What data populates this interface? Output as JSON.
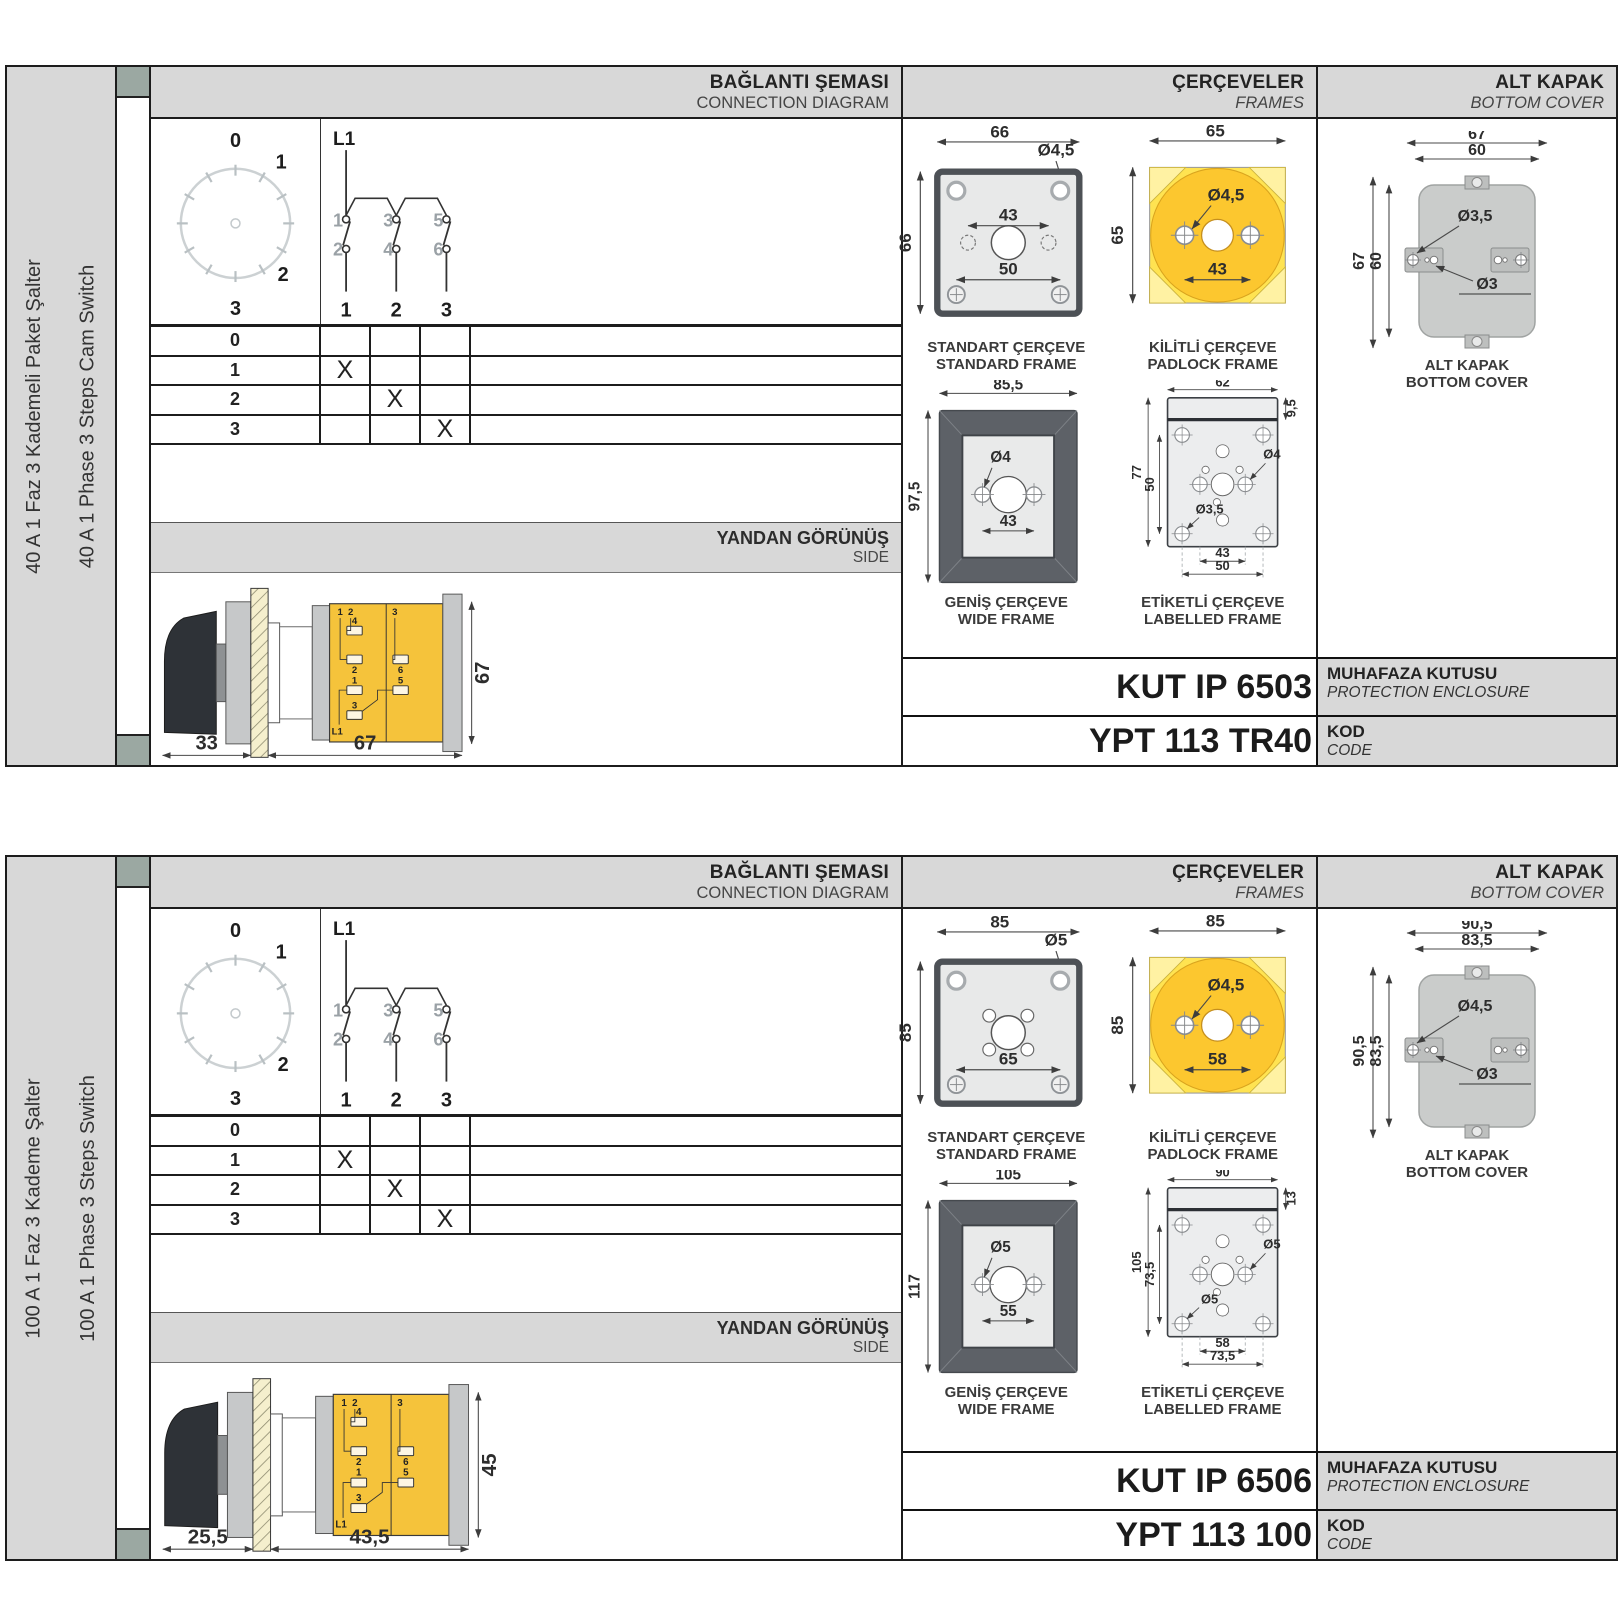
{
  "sections": [
    {
      "side_label_tr": "40 A 1 Faz 3 Kademeli Paket Şalter",
      "side_label_en": "40 A 1 Phase 3 Steps Cam Switch",
      "headers": {
        "connection_tr": "BAĞLANTI ŞEMASI",
        "connection_en": "CONNECTION DIAGRAM",
        "frames_tr": "ÇERÇEVELER",
        "frames_en": "FRAMES",
        "cover_tr": "ALT KAPAK",
        "cover_en": "BOTTOM COVER",
        "side_tr": "YANDAN GÖRÜNÜŞ",
        "side_en": "SIDE"
      },
      "dial": {
        "p0": "0",
        "p1": "1",
        "p2": "2",
        "p3": "3"
      },
      "circuit": {
        "phase": "L1",
        "c1": "1",
        "c2": "2",
        "c3": "3",
        "c4": "4",
        "c5": "5",
        "c6": "6",
        "o1": "1",
        "o2": "2",
        "o3": "3"
      },
      "table": {
        "rows": [
          {
            "label": "0",
            "c1": "",
            "c2": "",
            "c3": ""
          },
          {
            "label": "1",
            "c1": "X",
            "c2": "",
            "c3": ""
          },
          {
            "label": "2",
            "c1": "",
            "c2": "X",
            "c3": ""
          },
          {
            "label": "3",
            "c1": "",
            "c2": "",
            "c3": "X"
          }
        ]
      },
      "side_view": {
        "dim_handle": "33",
        "dim_body": "67",
        "dim_height": "67",
        "k1": "1",
        "k2": "2",
        "k3": "3",
        "t4": "4",
        "t2": "2",
        "t1": "1",
        "t3": "3",
        "t6": "6",
        "t5": "5",
        "l1": "L1"
      },
      "frames": {
        "standard": {
          "cap_tr": "STANDART ÇERÇEVE",
          "cap_en": "STANDARD FRAME",
          "dim_w": "66",
          "dim_h": "66",
          "hole": "Ø4,5",
          "dim_mid": "43",
          "dim_bot": "50"
        },
        "padlock": {
          "cap_tr": "KİLİTLİ ÇERÇEVE",
          "cap_en": "PADLOCK FRAME",
          "dim_w": "65",
          "dim_h": "65",
          "hole": "Ø4,5",
          "dim_mid": "43"
        },
        "wide": {
          "cap_tr": "GENİŞ ÇERÇEVE",
          "cap_en": "WIDE FRAME",
          "dim_w": "85,5",
          "dim_h": "97,5",
          "hole": "Ø4",
          "dim_mid": "43"
        },
        "labelled": {
          "cap_tr": "ETİKETLİ ÇERÇEVE",
          "cap_en": "LABELLED FRAME",
          "dim_w": "62",
          "dim_strip": "9,5",
          "dim_h": "77",
          "dim_inner": "50",
          "hole_big": "Ø4",
          "hole_small": "Ø3,5",
          "dim_b1": "43",
          "dim_b2": "50"
        }
      },
      "cover": {
        "cap_tr": "ALT KAPAK",
        "cap_en": "BOTTOM COVER",
        "dim_w1": "67",
        "dim_w2": "60",
        "dim_h1": "67",
        "dim_h2": "60",
        "hole1": "Ø3,5",
        "hole2": "Ø3"
      },
      "enclosure": {
        "value": "KUT IP 6503",
        "label_tr": "MUHAFAZA KUTUSU",
        "label_en": "PROTECTION ENCLOSURE"
      },
      "code": {
        "value": "YPT 113 TR40",
        "label_tr": "KOD",
        "label_en": "CODE"
      }
    },
    {
      "side_label_tr": "100 A 1 Faz 3 Kademe Şalter",
      "side_label_en": "100 A 1 Phase 3 Steps Switch",
      "headers": {
        "connection_tr": "BAĞLANTI ŞEMASI",
        "connection_en": "CONNECTION DIAGRAM",
        "frames_tr": "ÇERÇEVELER",
        "frames_en": "FRAMES",
        "cover_tr": "ALT KAPAK",
        "cover_en": "BOTTOM COVER",
        "side_tr": "YANDAN GÖRÜNÜŞ",
        "side_en": "SIDE"
      },
      "dial": {
        "p0": "0",
        "p1": "1",
        "p2": "2",
        "p3": "3"
      },
      "circuit": {
        "phase": "L1",
        "c1": "1",
        "c2": "2",
        "c3": "3",
        "c4": "4",
        "c5": "5",
        "c6": "6",
        "o1": "1",
        "o2": "2",
        "o3": "3"
      },
      "table": {
        "rows": [
          {
            "label": "0",
            "c1": "",
            "c2": "",
            "c3": ""
          },
          {
            "label": "1",
            "c1": "X",
            "c2": "",
            "c3": ""
          },
          {
            "label": "2",
            "c1": "",
            "c2": "X",
            "c3": ""
          },
          {
            "label": "3",
            "c1": "",
            "c2": "",
            "c3": "X"
          }
        ]
      },
      "side_view": {
        "dim_handle": "25,5",
        "dim_body": "43,5",
        "dim_height": "45",
        "k1": "1",
        "k2": "2",
        "k3": "3",
        "t4": "4",
        "t2": "2",
        "t1": "1",
        "t3": "3",
        "t6": "6",
        "t5": "5",
        "l1": "L1"
      },
      "frames": {
        "standard": {
          "cap_tr": "STANDART ÇERÇEVE",
          "cap_en": "STANDARD FRAME",
          "dim_w": "85",
          "dim_h": "85",
          "hole": "Ø5",
          "dim_bot": "65"
        },
        "padlock": {
          "cap_tr": "KİLİTLİ ÇERÇEVE",
          "cap_en": "PADLOCK FRAME",
          "dim_w": "85",
          "dim_h": "85",
          "hole": "Ø4,5",
          "dim_mid": "58"
        },
        "wide": {
          "cap_tr": "GENİŞ ÇERÇEVE",
          "cap_en": "WIDE FRAME",
          "dim_w": "105",
          "dim_h": "117",
          "hole": "Ø5",
          "dim_mid": "55"
        },
        "labelled": {
          "cap_tr": "ETİKETLİ ÇERÇEVE",
          "cap_en": "LABELLED FRAME",
          "dim_w": "90",
          "dim_strip": "13",
          "dim_h": "105",
          "dim_inner": "73,5",
          "hole_big": "Ø5",
          "hole_small": "Ø5",
          "dim_b1": "58",
          "dim_b2": "73,5"
        }
      },
      "cover": {
        "cap_tr": "ALT KAPAK",
        "cap_en": "BOTTOM COVER",
        "dim_w1": "90,5",
        "dim_w2": "83,5",
        "dim_h1": "90,5",
        "dim_h2": "83,5",
        "hole1": "Ø4,5",
        "hole2": "Ø3"
      },
      "enclosure": {
        "value": "KUT IP 6506",
        "label_tr": "MUHAFAZA KUTUSU",
        "label_en": "PROTECTION ENCLOSURE"
      },
      "code": {
        "value": "YPT 113 100",
        "label_tr": "KOD",
        "label_en": "CODE"
      }
    }
  ]
}
